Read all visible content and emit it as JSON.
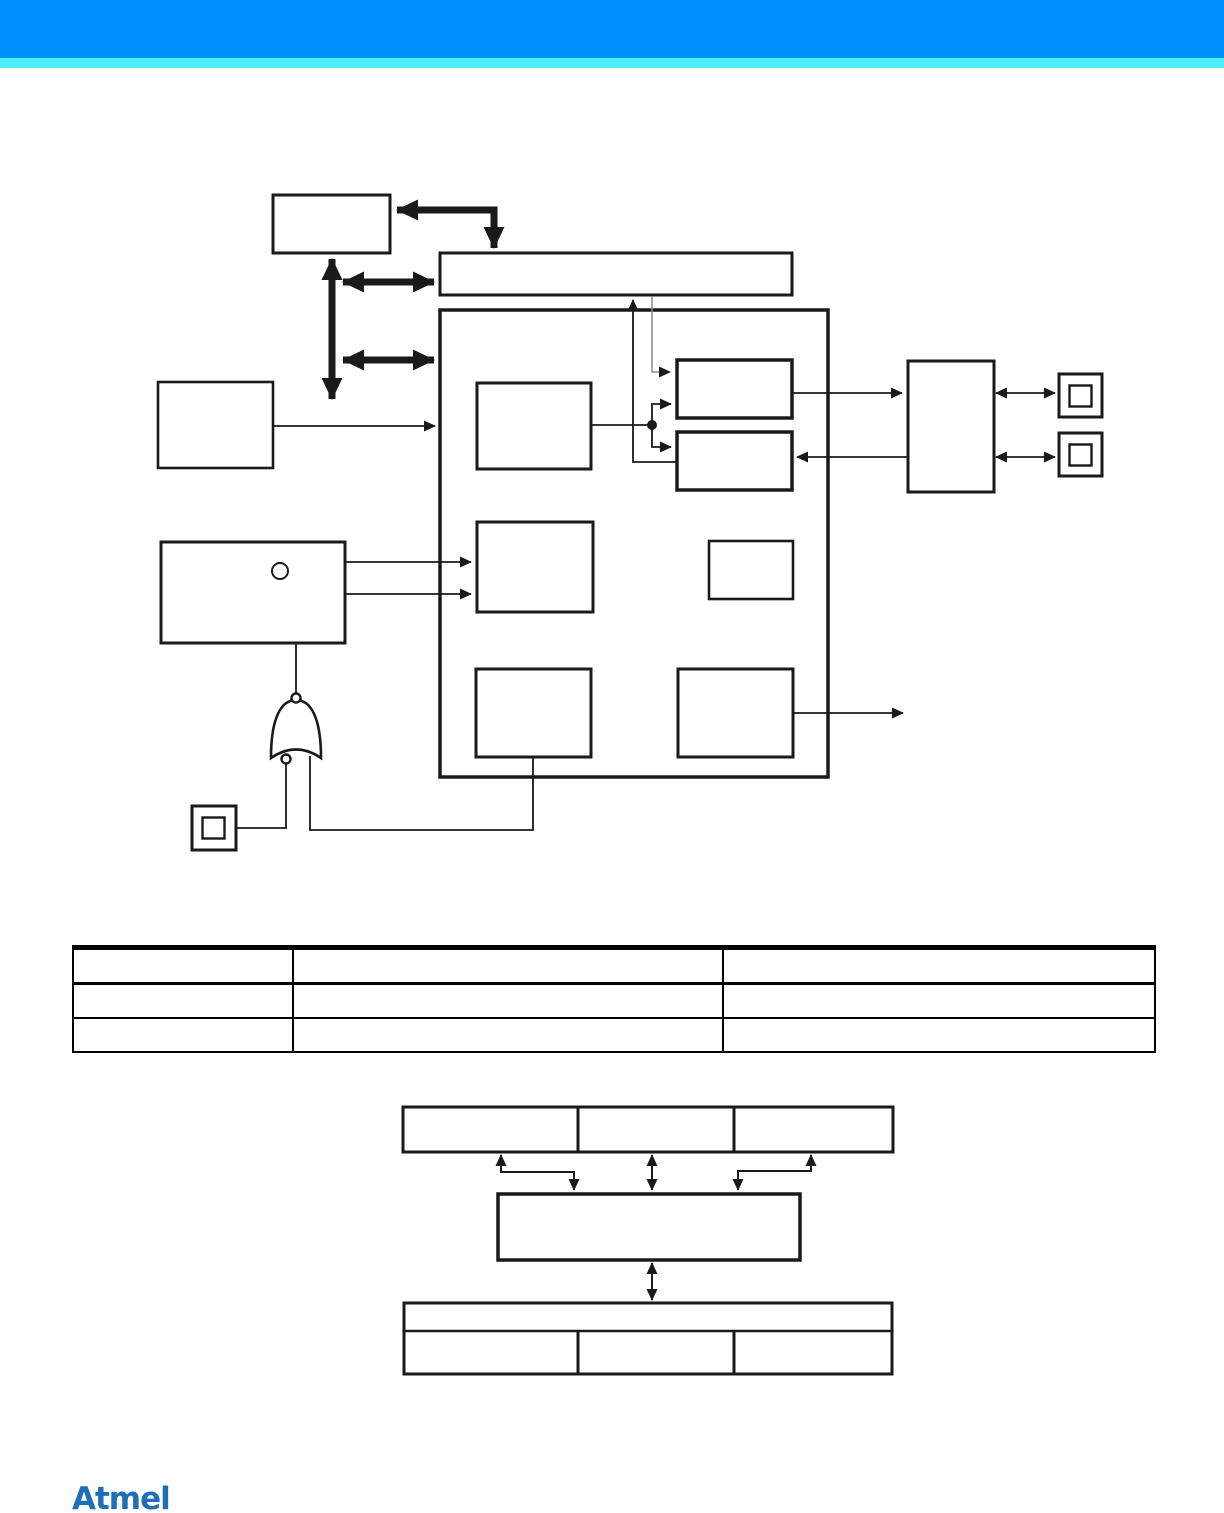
{
  "page": {
    "width": 1224,
    "height": 1513,
    "background": "#ffffff"
  },
  "header": {
    "bar_color": "#0090ff",
    "strip_color": "#4deeff"
  },
  "diagram": {
    "line_color": "#1a1a1a",
    "top_figure": {
      "type": "block-diagram",
      "box_count": 13,
      "pin_pad_count": 3,
      "gate_count": 1,
      "box_labels": [
        "",
        "",
        "",
        "",
        "",
        "",
        "",
        "",
        "",
        "",
        "",
        "",
        ""
      ]
    },
    "bottom_figure": {
      "type": "block-diagram",
      "top_row_cells": [
        "",
        "",
        ""
      ],
      "middle_box_label": "",
      "bottom_band_label": "",
      "bottom_row_cells": [
        "",
        "",
        ""
      ]
    }
  },
  "table": {
    "columns": [
      "",
      "",
      ""
    ],
    "rows": [
      [
        "",
        "",
        ""
      ],
      [
        "",
        "",
        ""
      ]
    ]
  },
  "footer": {
    "logo_text": "Atmel",
    "logo_color": "#1f6fb7"
  }
}
